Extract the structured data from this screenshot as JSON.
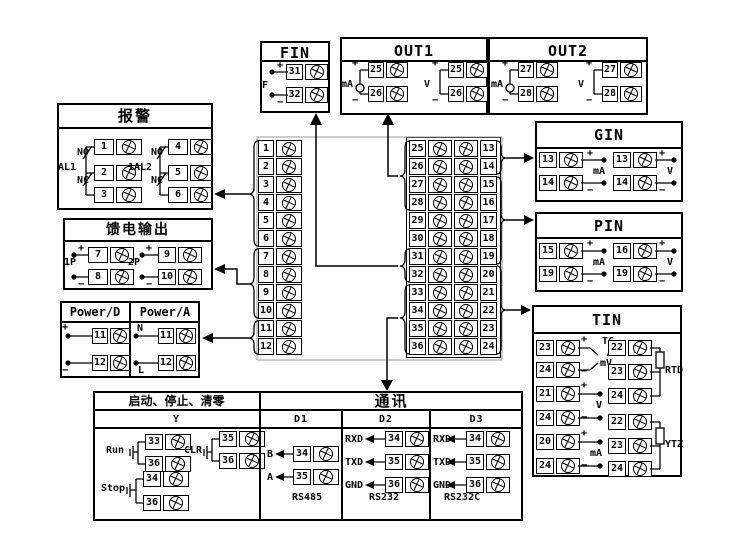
{
  "fin": {
    "title": "FIN",
    "f": "F",
    "plus": "+",
    "minus": "−",
    "t1": "31",
    "t2": "32"
  },
  "out1": {
    "title": "OUT1",
    "g1": {
      "label": "mA",
      "plus": "+",
      "minus": "−",
      "t1": "25",
      "t2": "26"
    },
    "g2": {
      "label": "V",
      "plus": "+",
      "minus": "−",
      "t1": "25",
      "t2": "26"
    }
  },
  "out2": {
    "title": "OUT2",
    "g1": {
      "label": "mA",
      "plus": "+",
      "minus": "−",
      "t1": "27",
      "t2": "28"
    },
    "g2": {
      "label": "V",
      "plus": "+",
      "minus": "−",
      "t1": "27",
      "t2": "28"
    }
  },
  "alarm": {
    "title": "报警",
    "g1": {
      "label": "AL1",
      "no": "NO",
      "nc": "NC",
      "t1": "1",
      "t2": "2",
      "t3": "3"
    },
    "g2": {
      "label": "1AL2",
      "no": "NO",
      "nc": "NC",
      "t1": "4",
      "t2": "5",
      "t3": "6"
    }
  },
  "feed": {
    "title": "馈电输出",
    "g1": {
      "label": "1P",
      "plus": "+",
      "minus": "−",
      "t1": "7",
      "t2": "8"
    },
    "g2": {
      "label": "2P",
      "plus": "+",
      "minus": "−",
      "t1": "9",
      "t2": "10"
    }
  },
  "power": {
    "title_d": "Power/D",
    "title_a": "Power/A",
    "d": {
      "plus": "+",
      "minus": "−",
      "t1": "11",
      "t2": "12"
    },
    "a": {
      "n": "N",
      "l": "L",
      "t1": "11",
      "t2": "12"
    }
  },
  "gin": {
    "title": "GIN",
    "g1": {
      "label": "mA",
      "plus": "+",
      "minus": "−",
      "t1": "13",
      "t2": "14"
    },
    "g2": {
      "label": "V",
      "plus": "+",
      "minus": "−",
      "t1": "13",
      "t2": "14"
    }
  },
  "pin": {
    "title": "PIN",
    "g1": {
      "label": "mA",
      "plus": "+",
      "minus": "−",
      "t1": "15",
      "t2": "19"
    },
    "g2": {
      "label": "V",
      "plus": "+",
      "minus": "−",
      "t1": "16",
      "t2": "19"
    }
  },
  "tin": {
    "title": "TIN",
    "tc": {
      "plus": "+",
      "minus": "−",
      "l1": "TC",
      "l2": "/",
      "l3": "mV",
      "t1": "23",
      "t2": "24"
    },
    "v": {
      "plus": "+",
      "minus": "−",
      "label": "V",
      "t1": "21",
      "t2": "24"
    },
    "ma": {
      "plus": "+",
      "minus": "−",
      "label": "mA",
      "t1": "20",
      "t2": "24"
    },
    "rtd": {
      "label": "RTD",
      "t1": "22",
      "t2": "23",
      "t3": "24"
    },
    "ytz": {
      "label": "YTZ",
      "t1": "22",
      "t2": "23",
      "t3": "24"
    }
  },
  "control": {
    "title": "启动、停止、清零",
    "col": "Y",
    "run": {
      "label": "Run",
      "t1": "33",
      "t2": "36"
    },
    "clr": {
      "label": "CLR",
      "t1": "35",
      "t2": "36"
    },
    "stop": {
      "label": "Stop",
      "t1": "34",
      "t2": "36"
    }
  },
  "comm": {
    "title": "通讯",
    "d1": {
      "name": "D1",
      "r1": {
        "label": "B",
        "t": "34"
      },
      "r2": {
        "label": "A",
        "t": "35"
      },
      "type": "RS485"
    },
    "d2": {
      "name": "D2",
      "r1": {
        "label": "RXD",
        "t": "34"
      },
      "r2": {
        "label": "TXD",
        "t": "35"
      },
      "r3": {
        "label": "GND",
        "t": "36"
      },
      "type": "RS232"
    },
    "d3": {
      "name": "D3",
      "r1": {
        "label": "RXD",
        "t": "34"
      },
      "r2": {
        "label": "TXD",
        "t": "35"
      },
      "r3": {
        "label": "GND",
        "t": "36"
      },
      "type": "RS232C"
    }
  },
  "strip_left": [
    "1",
    "2",
    "3",
    "4",
    "5",
    "6",
    "7",
    "8",
    "9",
    "10",
    "11",
    "12"
  ],
  "strip_right_a": [
    "25",
    "26",
    "27",
    "28",
    "29",
    "30",
    "31",
    "32",
    "33",
    "34",
    "35",
    "36"
  ],
  "strip_right_b": [
    "13",
    "14",
    "15",
    "16",
    "17",
    "18",
    "19",
    "20",
    "21",
    "22",
    "23",
    "24"
  ],
  "colors": {
    "line": "#000000",
    "faint": "#9a9a9a",
    "background": "#ffffff"
  }
}
